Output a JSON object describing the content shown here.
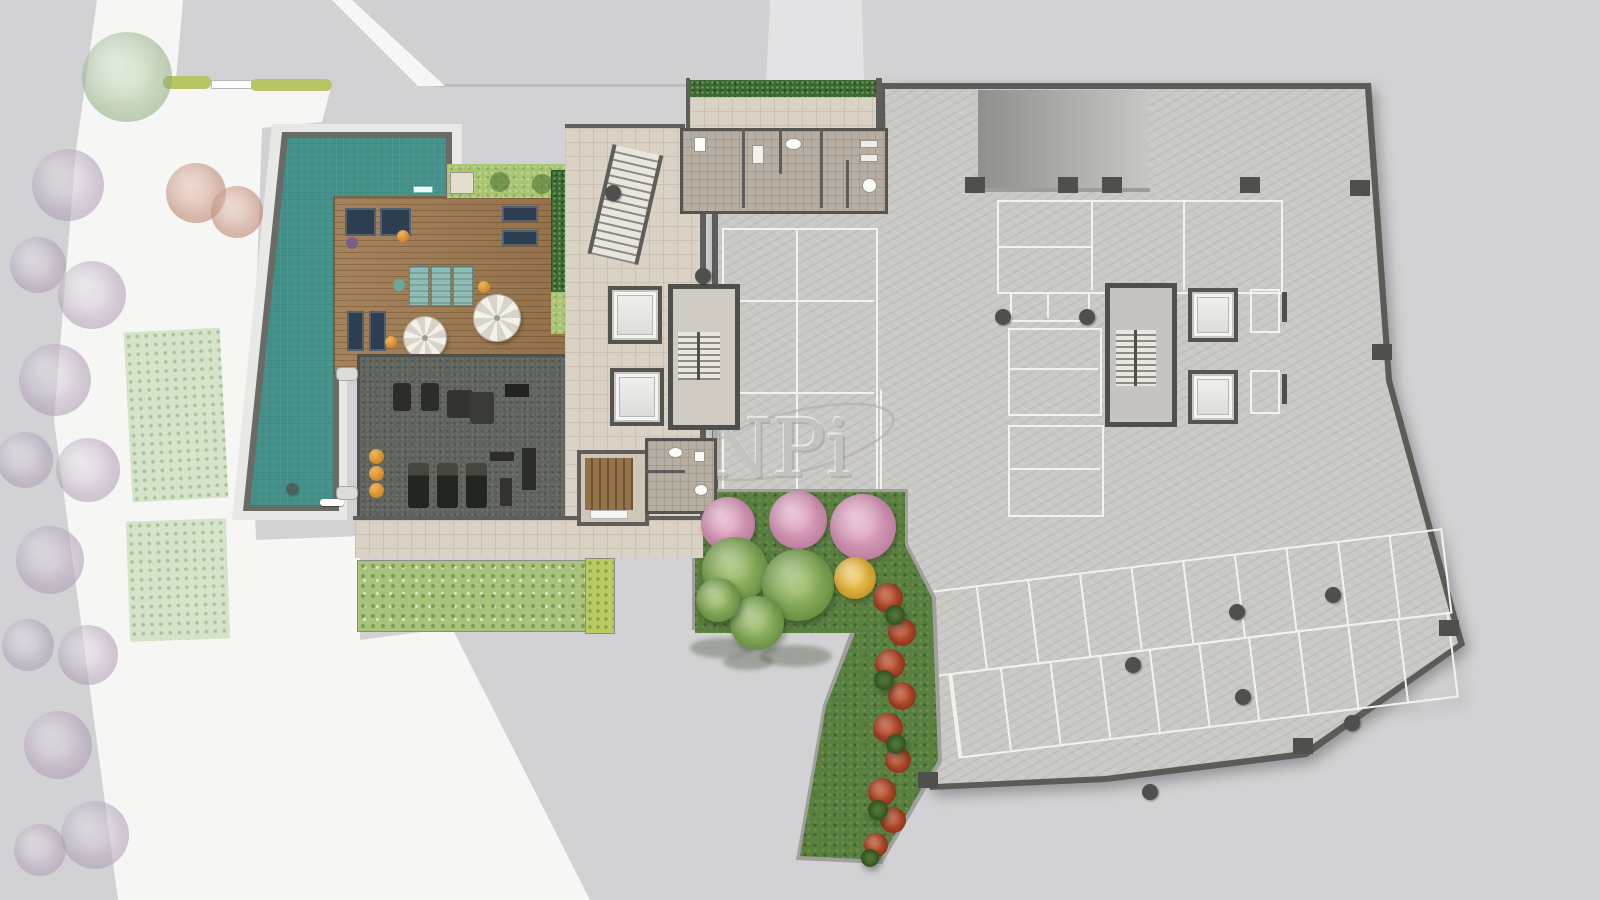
{
  "watermark": {
    "text": "NPi"
  },
  "colors": {
    "background": "#d2d2d4",
    "ground_white": "#f6f6f4",
    "driveway": "#d0d0d2",
    "wall_dark": "#5f5e5a",
    "pool_water": "#3d8d86",
    "pool_wall": "#6b6b66",
    "deck_wood": "#a07a4f",
    "lawn_green": "#a9c573",
    "hedge_green": "#3c6b31",
    "gym_floor": "#60645f",
    "terrace_tile": "#dbd2c6",
    "bath_tile": "#b6aea3",
    "garage_floor": "#cac9c6",
    "garage_wall": "#5b5b58",
    "stall_line": "#f2f2f0",
    "garden_grass": "#5a8040",
    "tree_pink": "#c98cad",
    "tree_green": "#7ca353",
    "tree_yellow": "#d9a530",
    "shrub_red": "#a33d24",
    "tree_lilac": "#c0b1c5",
    "furniture_navy": "#2c3e50",
    "lounger_teal": "#8fbcb4",
    "accent_orange": "#e09a3a"
  },
  "plan": {
    "lilac_trees": [
      [
        68,
        185,
        36
      ],
      [
        38,
        265,
        28
      ],
      [
        92,
        295,
        34
      ],
      [
        55,
        380,
        36
      ],
      [
        25,
        460,
        28
      ],
      [
        88,
        470,
        32
      ],
      [
        50,
        560,
        34
      ],
      [
        28,
        645,
        26
      ],
      [
        88,
        655,
        30
      ],
      [
        58,
        745,
        34
      ],
      [
        95,
        835,
        34
      ],
      [
        40,
        850,
        26
      ]
    ],
    "faded_green_trees": [
      [
        127,
        77,
        45
      ]
    ],
    "faded_red_trees": [
      [
        196,
        193,
        30
      ],
      [
        237,
        212,
        26
      ]
    ],
    "pink_trees": [
      [
        728,
        524,
        27
      ],
      [
        798,
        520,
        29
      ],
      [
        863,
        527,
        33
      ]
    ],
    "green_trees": [
      [
        735,
        570,
        33
      ],
      [
        798,
        585,
        36
      ],
      [
        757,
        623,
        27
      ],
      [
        718,
        600,
        22
      ]
    ],
    "yellow_trees": [
      [
        855,
        578,
        21
      ]
    ],
    "red_shrubs": [
      [
        888,
        598,
        15
      ],
      [
        902,
        632,
        14
      ],
      [
        890,
        664,
        15
      ],
      [
        902,
        696,
        14
      ],
      [
        888,
        728,
        15
      ],
      [
        898,
        760,
        13
      ],
      [
        882,
        792,
        14
      ],
      [
        893,
        820,
        13
      ],
      [
        876,
        845,
        12
      ]
    ],
    "green_shrubs": [
      [
        895,
        615,
        10
      ],
      [
        884,
        680,
        10
      ],
      [
        896,
        744,
        10
      ],
      [
        878,
        810,
        10
      ],
      [
        870,
        858,
        9
      ]
    ],
    "tree_shadows": [
      [
        722,
        648,
        64,
        20
      ],
      [
        796,
        656,
        72,
        22
      ],
      [
        748,
        662,
        50,
        16
      ]
    ],
    "round_columns": [
      [
        1003,
        317
      ],
      [
        1087,
        317
      ],
      [
        1237,
        612
      ],
      [
        1133,
        665
      ],
      [
        1243,
        697
      ],
      [
        1352,
        723
      ],
      [
        1150,
        792
      ],
      [
        1333,
        595
      ],
      [
        613,
        193
      ],
      [
        703,
        276
      ]
    ],
    "square_columns": [
      [
        975,
        185
      ],
      [
        1068,
        185
      ],
      [
        1112,
        185
      ],
      [
        1250,
        185
      ],
      [
        1360,
        188
      ],
      [
        1382,
        352
      ],
      [
        1449,
        628
      ],
      [
        1303,
        746
      ],
      [
        928,
        780
      ]
    ]
  }
}
